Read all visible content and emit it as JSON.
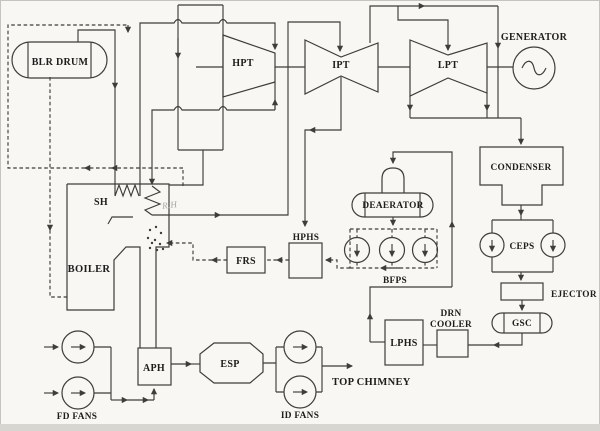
{
  "colors": {
    "paper": "#f8f7f3",
    "line": "#3f3d3a",
    "text": "#1e1d1b",
    "faint": "#a9a7a0",
    "band": "#d8d6d0"
  },
  "labels": {
    "blr_drum": "BLR DRUM",
    "hpt": "HPT",
    "ipt": "IPT",
    "lpt": "LPT",
    "generator": "GENERATOR",
    "condenser": "CONDENSER",
    "deaerator": "DEAERATOR",
    "ceps": "CEPS",
    "ejector": "EJECTOR",
    "gsc": "GSC",
    "drn_cooler_line1": "DRN",
    "drn_cooler_line2": "COOLER",
    "lphs": "LPHS",
    "bfps": "BFPS",
    "hphs": "HPHS",
    "frs": "FRS",
    "sh": "SH",
    "rh": "R.H",
    "boiler": "BOILER",
    "aph": "APH",
    "esp": "ESP",
    "fd_fans": "FD FANS",
    "id_fans": "ID FANS",
    "top_chimney": "TOP CHIMNEY"
  }
}
